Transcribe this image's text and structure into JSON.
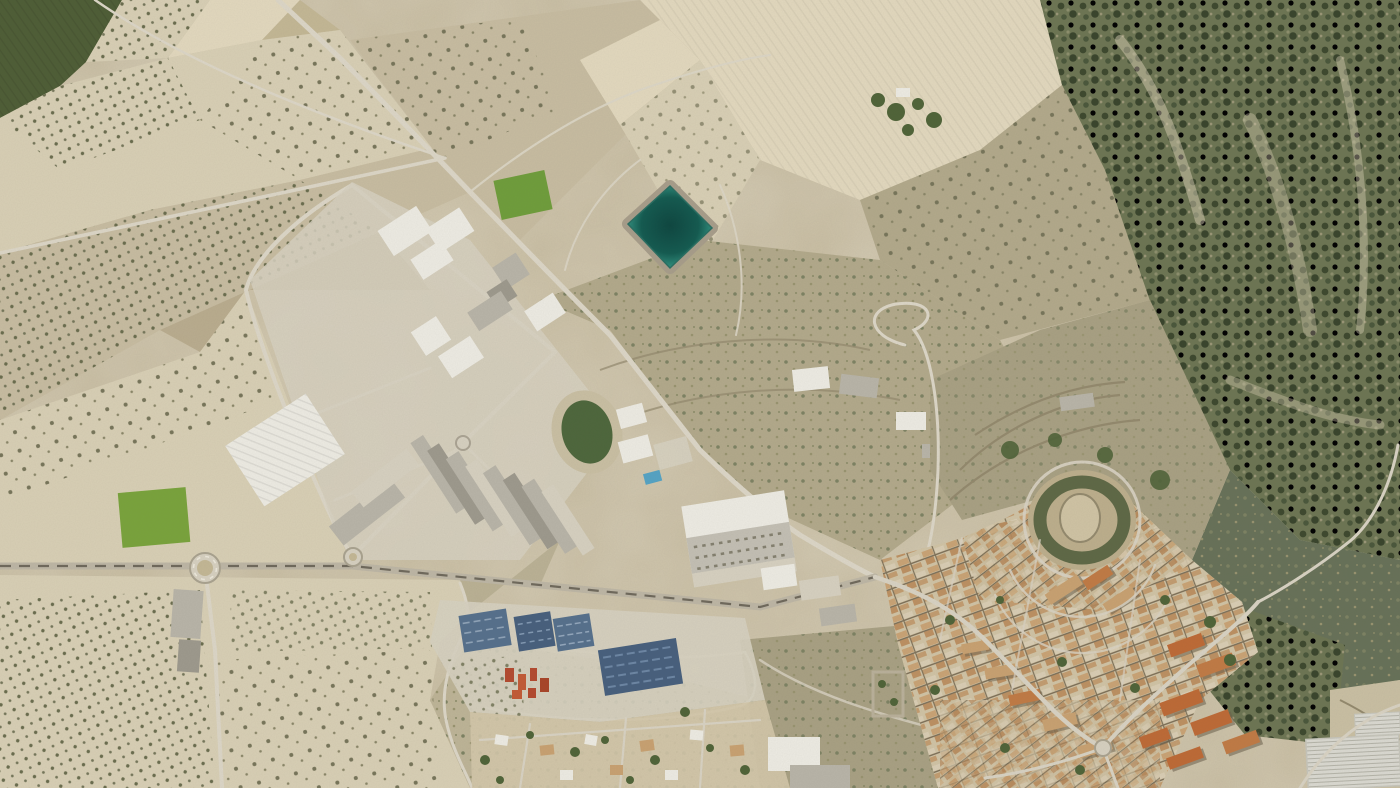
{
  "meta": {
    "kind": "aerial-orthophoto-satellite-view",
    "visible_text": "",
    "description": "Top-down aerial imagery of a Mediterranean town: olive-grove farmland on the left, a tilted industrial estate with white warehouses, a turquoise square irrigation reservoir, a dark green sports pitch, blue storage yards, a dense old town with tan and orange roofs around a castle hill, wooded hills upper right, greenhouses bottom right.",
    "width_px": 1400,
    "height_px": 788
  },
  "palette": {
    "base": "#c7bca1",
    "field_pale": "#d8cfb5",
    "field_cream": "#e2d8be",
    "field_tan": "#c3b795",
    "field_brown": "#b0a283",
    "field_dark": "#a39878",
    "green_dark": "#4e5d36",
    "green_bright": "#79a33c",
    "green_field": "#6f9d3b",
    "forest_base": "#6d7553",
    "forest_dark": "#3d482e",
    "forest_mid": "#55634a",
    "scrub": "#b2a98b",
    "terrace": "#a8a083",
    "terrace_line": "#93896d",
    "road_light": "#dcd6c7",
    "road_mid": "#bdb6a5",
    "road_dark": "#6f695c",
    "concrete": "#d6d0c0",
    "warehouse_white": "#edebe3",
    "roof_gray": "#b8b4a8",
    "roof_gray_dark": "#9d998d",
    "water_rim": "#49b59f",
    "water_mid": "#1d7a6b",
    "water_deep": "#0d4640",
    "embank": "#a79d8a",
    "pitch_green": "#4d663c",
    "track_tan": "#c9bfa3",
    "pool_blue": "#55a3c4",
    "yard_blue": "#56708c",
    "yard_blue_dark": "#475f7d",
    "red_accent": "#b34a2f",
    "town_base": "#d3c7aa",
    "roof_tan": "#c8a171",
    "roof_orange": "#c07a45",
    "block_orange": "#bd6a36",
    "shadow": "#6a5f4b",
    "tree_green": "#4f6338",
    "street": "#d8d2c3",
    "gh_white": "#dad9d1",
    "gh_line": "#b4b3a8",
    "hill_tan": "#bcae8c",
    "rock": "#cfc3a4"
  },
  "features": [
    {
      "name": "olive-grove-fields",
      "area": "left and bottom-left"
    },
    {
      "name": "industrial-estate",
      "area": "center-left, tilted grid of white warehouses"
    },
    {
      "name": "irrigation-reservoir",
      "area": "upper center, turquoise rotated square"
    },
    {
      "name": "sports-pitch-and-pool",
      "area": "center"
    },
    {
      "name": "large-warehouse",
      "area": "center, white roof with vent rows"
    },
    {
      "name": "blue-storage-yards",
      "area": "lower center"
    },
    {
      "name": "residential-suburb",
      "area": "bottom center"
    },
    {
      "name": "old-town",
      "area": "right, concentric streets around castle hill"
    },
    {
      "name": "castle-hill",
      "area": "right center"
    },
    {
      "name": "forest-hills",
      "area": "upper right"
    },
    {
      "name": "greenhouses",
      "area": "bottom-right corner"
    },
    {
      "name": "highway-with-roundabout",
      "area": "left, horizontal"
    },
    {
      "name": "main-diagonal-road",
      "area": "from top-left toward town"
    }
  ]
}
